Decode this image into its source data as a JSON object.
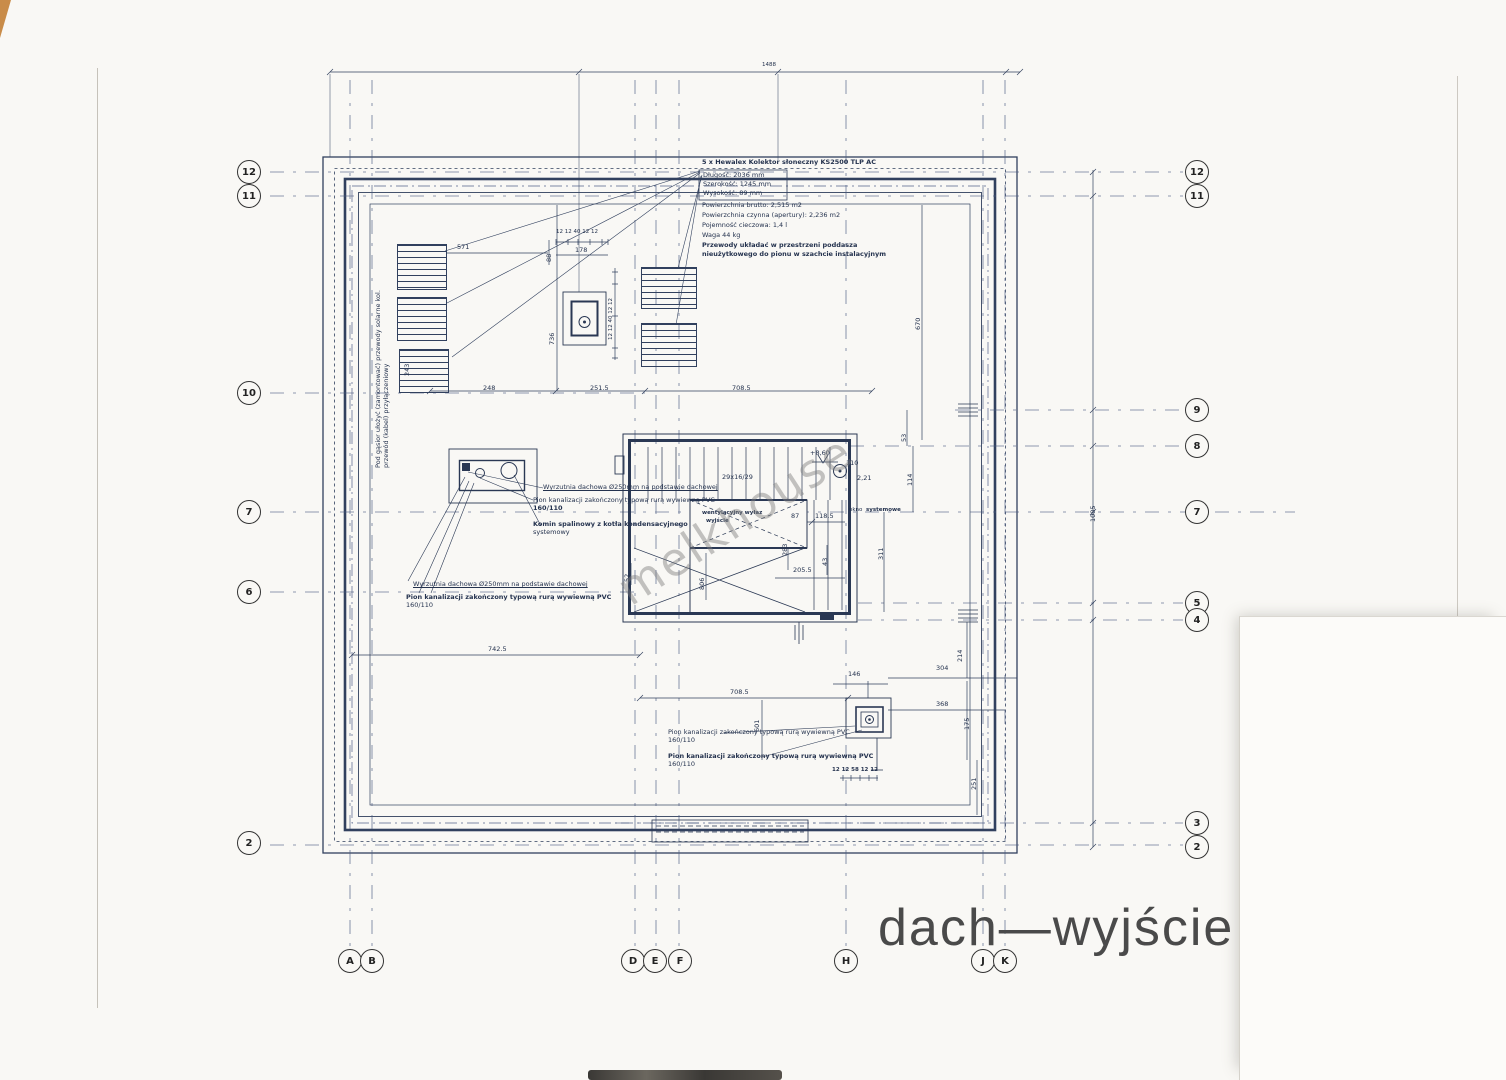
{
  "title": "dach—wyjście",
  "watermark": "melkhouse",
  "solar_note": {
    "header": "5 x Hewalex Kolektor słoneczny KS2500 TLP AC",
    "boxed": [
      "Długość:  2036 mm",
      "Szerokość:  1245 mm",
      "Wysokość:  89 mm"
    ],
    "lines": [
      "Powierzchnia brutto:  2,515 m2",
      "Powierzchnia czynna (apertury):  2,236 m2",
      "Pojemność cieczowa:  1,4 l",
      "Waga 44 kg",
      "Przewody układać w przestrzeni poddasza",
      "nieużytkowego do pionu w szachcie instalacyjnym"
    ]
  },
  "roof_note": {
    "line1": "Pod gąsior ułożyć (zamontować) przewody solarne kol.",
    "line2": "przewód (kabel) przyłączeniowy"
  },
  "chimney": {
    "wyrzutnia": "Wyrzutnia dachowa Ø250mm na podstawie dachowej",
    "pion": "Pion kanalizacji zakończony typową rurą wywiewną PVC",
    "pion_size": "160/110",
    "komin1": "Komin spalinowy z kotła kondensacyjnego",
    "komin2": "systemowy"
  },
  "stair": {
    "treads": "29x16/29",
    "elevation": "+8,60",
    "n110": "110",
    "n221": "2,21",
    "hatch1": "wentylacyjny wyłaz",
    "hatch2": "wyjście",
    "okno": "okno",
    "systemowe": "systemowe"
  },
  "dims": {
    "total_top": "1488",
    "d571": "571",
    "d88": "88",
    "d178": "178",
    "comb_top": "12 12 40 12 12",
    "d243": "243",
    "d736": "736",
    "comb_right": "12 12 40 12 12",
    "d248": "248",
    "d2515": "251.5",
    "d7085a": "708.5",
    "d7425": "742.5",
    "d7085b": "708.5",
    "d146": "146",
    "d304": "304",
    "d368": "368",
    "d214": "214",
    "d601": "601",
    "d175": "175",
    "d251": "251",
    "comb_bottom": "12 12 58 12 12",
    "d87": "87",
    "d1185": "118.5",
    "d2055": "205.5",
    "d283": "283",
    "d43": "43",
    "d311": "311",
    "d53": "53",
    "d114": "114",
    "d52": "52",
    "d806": "806",
    "d670": "670",
    "d1085": "1085"
  },
  "grid": {
    "left": [
      "12",
      "11",
      "10",
      "7",
      "6",
      "2"
    ],
    "right": [
      "12",
      "11",
      "9",
      "8",
      "7",
      "5",
      "4",
      "3",
      "2"
    ],
    "bottom": [
      "A",
      "B",
      "D",
      "E",
      "F",
      "H",
      "J",
      "K"
    ]
  }
}
